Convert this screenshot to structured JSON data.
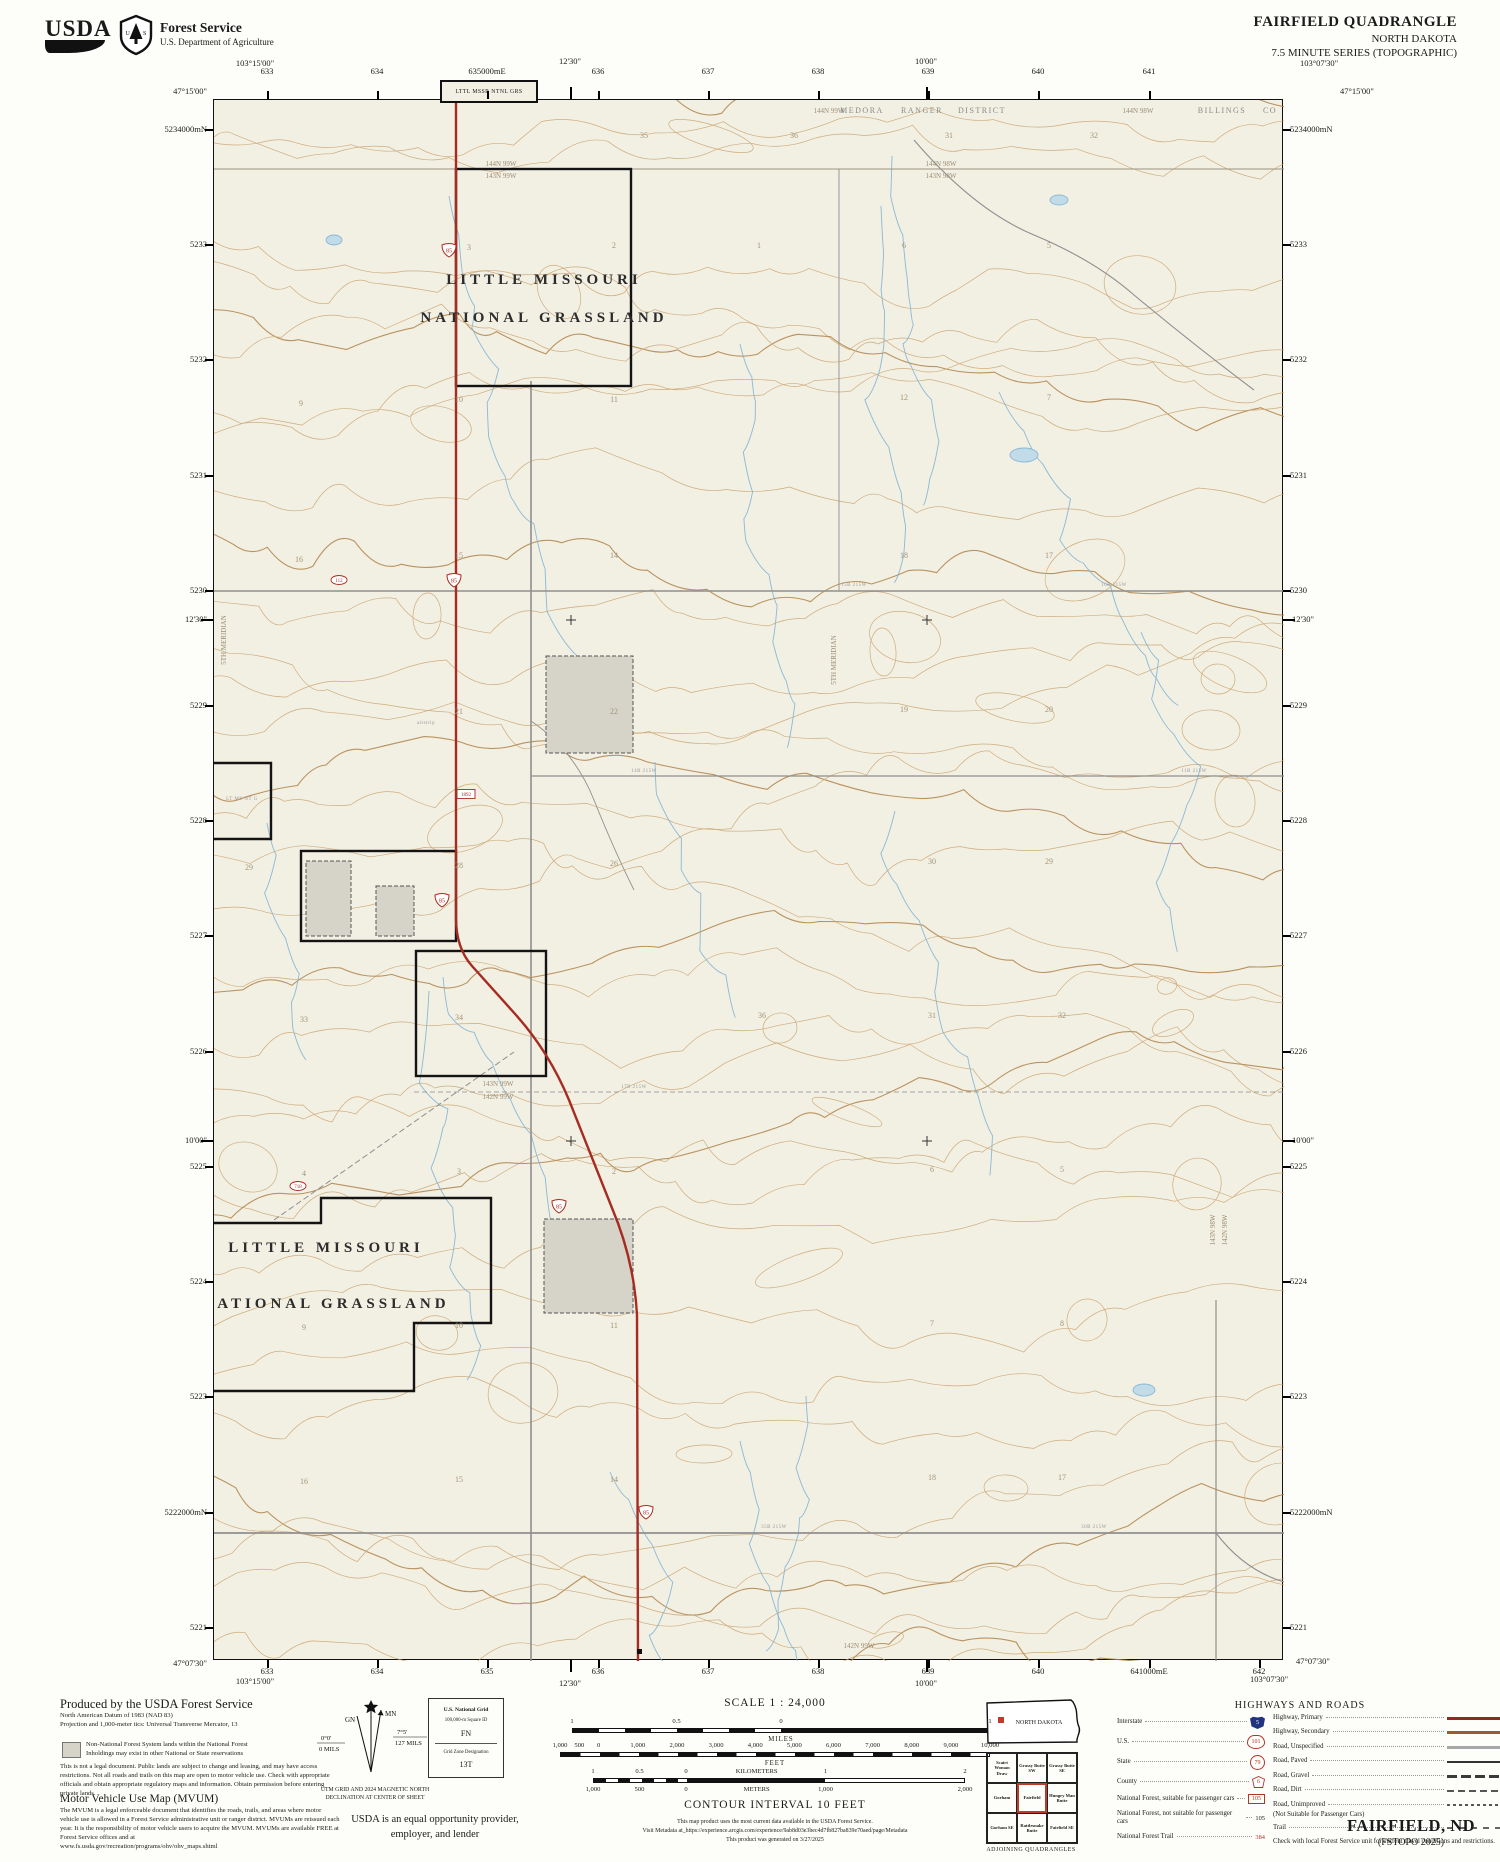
{
  "header": {
    "usda_wordmark": "USDA",
    "agency": "Forest Service",
    "dept": "U.S. Department of Agriculture",
    "quad_title": "FAIRFIELD QUADRANGLE",
    "state_title": "NORTH DAKOTA",
    "series": "7.5 MINUTE SERIES (TOPOGRAPHIC)"
  },
  "collar": {
    "tl_lon": "103°15'00\"",
    "tl_lat": "47°15'00\"",
    "tr_lon": "103°07'30\"",
    "tr_lat": "47°15'00\"",
    "bl_lat": "47°07'30\"",
    "bl_lon": "103°15'00\"",
    "br_lat": "47°07'30\"",
    "br_lon": "103°07'30\"",
    "top_minutes": [
      {
        "t": "12'30\"",
        "x": 570
      },
      {
        "t": "10'00\"",
        "x": 926
      }
    ],
    "bottom_minutes": [
      {
        "t": "12'30\"",
        "x": 570
      },
      {
        "t": "10'00\"",
        "x": 926
      }
    ],
    "side_minutes": [
      {
        "t": "12'30\"",
        "y": 619
      },
      {
        "t": "10'00\"",
        "y": 1140
      }
    ],
    "top_eastings": [
      {
        "t": "633",
        "x": 267
      },
      {
        "t": "634",
        "x": 377
      },
      {
        "t": "635000mE",
        "x": 487
      },
      {
        "t": "636",
        "x": 598
      },
      {
        "t": "637",
        "x": 708
      },
      {
        "t": "638",
        "x": 818
      },
      {
        "t": "639",
        "x": 928
      },
      {
        "t": "640",
        "x": 1038
      },
      {
        "t": "641",
        "x": 1149
      }
    ],
    "bottom_eastings": [
      {
        "t": "633",
        "x": 267
      },
      {
        "t": "634",
        "x": 377
      },
      {
        "t": "635",
        "x": 487
      },
      {
        "t": "636",
        "x": 598
      },
      {
        "t": "637",
        "x": 708
      },
      {
        "t": "638",
        "x": 818
      },
      {
        "t": "639",
        "x": 928
      },
      {
        "t": "640",
        "x": 1038
      },
      {
        "t": "641000mE",
        "x": 1149
      },
      {
        "t": "642",
        "x": 1259
      }
    ],
    "northings": [
      {
        "t": "5234000mN",
        "y": 129
      },
      {
        "t": "5233",
        "y": 244
      },
      {
        "t": "5232",
        "y": 359
      },
      {
        "t": "5231",
        "y": 475
      },
      {
        "t": "5230",
        "y": 590
      },
      {
        "t": "5229",
        "y": 705
      },
      {
        "t": "5228",
        "y": 820
      },
      {
        "t": "5227",
        "y": 935
      },
      {
        "t": "5226",
        "y": 1051
      },
      {
        "t": "5225",
        "y": 1166
      },
      {
        "t": "5224",
        "y": 1281
      },
      {
        "t": "5223",
        "y": 1396
      },
      {
        "t": "5222000mN",
        "y": 1512
      },
      {
        "t": "5221",
        "y": 1627
      }
    ]
  },
  "map": {
    "corner_box_label": "LTTL MSSR NTNL GRS",
    "labels": [
      {
        "t": "LITTLE MISSOURI",
        "x": 330,
        "y": 184,
        "c": "lmng"
      },
      {
        "t": "NATIONAL GRASSLAND",
        "x": 330,
        "y": 222,
        "c": "lmng"
      },
      {
        "t": "LITTLE MISSOURI",
        "x": 112,
        "y": 1152,
        "c": "lmng"
      },
      {
        "t": "NATIONAL GRASSLAND",
        "x": 112,
        "y": 1208,
        "c": "lmng"
      },
      {
        "t": "MEDORA",
        "x": 648,
        "y": 13,
        "c": "district"
      },
      {
        "t": "RANGER",
        "x": 708,
        "y": 13,
        "c": "district"
      },
      {
        "t": "DISTRICT",
        "x": 768,
        "y": 13,
        "c": "district"
      },
      {
        "t": "144N 99W",
        "x": 615,
        "y": 13,
        "c": "twp"
      },
      {
        "t": "144N 98W",
        "x": 924,
        "y": 13,
        "c": "twp"
      },
      {
        "t": "BILLINGS",
        "x": 1008,
        "y": 13,
        "c": "district"
      },
      {
        "t": "CO",
        "x": 1056,
        "y": 13,
        "c": "district"
      },
      {
        "t": "144N 99W",
        "x": 287,
        "y": 66,
        "c": "twp"
      },
      {
        "t": "143N 99W",
        "x": 287,
        "y": 78,
        "c": "twp"
      },
      {
        "t": "144N 98W",
        "x": 727,
        "y": 66,
        "c": "twp"
      },
      {
        "t": "143N 98W",
        "x": 727,
        "y": 78,
        "c": "twp"
      },
      {
        "t": "143N 99W",
        "x": 284,
        "y": 986,
        "c": "twp"
      },
      {
        "t": "142N 99W",
        "x": 284,
        "y": 999,
        "c": "twp"
      },
      {
        "t": "142N 99W",
        "x": 645,
        "y": 1548,
        "c": "twp"
      },
      {
        "t": "143N 98W",
        "x": 1001,
        "y": 1130,
        "c": "twp",
        "r": -90
      },
      {
        "t": "142N 98W",
        "x": 1013,
        "y": 1130,
        "c": "twp",
        "r": -90
      },
      {
        "t": "5TH MERIDIAN",
        "x": 622,
        "y": 560,
        "c": "twp",
        "r": -90
      },
      {
        "t": "5TH MERIDIAN",
        "x": 12,
        "y": 540,
        "c": "twp",
        "r": -90
      },
      {
        "t": "LT MS NT G",
        "x": 28,
        "y": 700,
        "c": "tinylab"
      },
      {
        "t": "airstrip",
        "x": 212,
        "y": 624,
        "c": "tinylab"
      }
    ],
    "road_names": [
      {
        "t": "14B 215W",
        "x": 430,
        "y": 672
      },
      {
        "t": "15B 215W",
        "x": 640,
        "y": 486
      },
      {
        "t": "16B 215W",
        "x": 900,
        "y": 486
      },
      {
        "t": "17B 215W",
        "x": 420,
        "y": 988
      },
      {
        "t": "35B 215W",
        "x": 560,
        "y": 1428
      },
      {
        "t": "30B 215W",
        "x": 880,
        "y": 1428
      },
      {
        "t": "11B 215W",
        "x": 980,
        "y": 672
      }
    ],
    "sections": [
      {
        "t": "35",
        "x": 430,
        "y": 38
      },
      {
        "t": "36",
        "x": 580,
        "y": 38
      },
      {
        "t": "31",
        "x": 735,
        "y": 38
      },
      {
        "t": "32",
        "x": 880,
        "y": 38
      },
      {
        "t": "3",
        "x": 255,
        "y": 150
      },
      {
        "t": "2",
        "x": 400,
        "y": 148
      },
      {
        "t": "1",
        "x": 545,
        "y": 148
      },
      {
        "t": "6",
        "x": 690,
        "y": 148
      },
      {
        "t": "5",
        "x": 835,
        "y": 148
      },
      {
        "t": "9",
        "x": 87,
        "y": 306
      },
      {
        "t": "10",
        "x": 245,
        "y": 302
      },
      {
        "t": "11",
        "x": 400,
        "y": 302
      },
      {
        "t": "12",
        "x": 690,
        "y": 300
      },
      {
        "t": "7",
        "x": 835,
        "y": 300
      },
      {
        "t": "16",
        "x": 85,
        "y": 462
      },
      {
        "t": "15",
        "x": 245,
        "y": 458
      },
      {
        "t": "14",
        "x": 400,
        "y": 458
      },
      {
        "t": "18",
        "x": 690,
        "y": 458
      },
      {
        "t": "17",
        "x": 835,
        "y": 458
      },
      {
        "t": "21",
        "x": 245,
        "y": 614
      },
      {
        "t": "22",
        "x": 400,
        "y": 614
      },
      {
        "t": "19",
        "x": 690,
        "y": 612
      },
      {
        "t": "20",
        "x": 835,
        "y": 612
      },
      {
        "t": "29",
        "x": 35,
        "y": 770
      },
      {
        "t": "28",
        "x": 245,
        "y": 768
      },
      {
        "t": "26",
        "x": 400,
        "y": 766
      },
      {
        "t": "30",
        "x": 718,
        "y": 764
      },
      {
        "t": "29",
        "x": 835,
        "y": 764
      },
      {
        "t": "33",
        "x": 90,
        "y": 922
      },
      {
        "t": "34",
        "x": 245,
        "y": 920
      },
      {
        "t": "36",
        "x": 548,
        "y": 918
      },
      {
        "t": "31",
        "x": 718,
        "y": 918
      },
      {
        "t": "32",
        "x": 848,
        "y": 918
      },
      {
        "t": "4",
        "x": 90,
        "y": 1076
      },
      {
        "t": "3",
        "x": 245,
        "y": 1074
      },
      {
        "t": "2",
        "x": 400,
        "y": 1074
      },
      {
        "t": "6",
        "x": 718,
        "y": 1072
      },
      {
        "t": "5",
        "x": 848,
        "y": 1072
      },
      {
        "t": "9",
        "x": 90,
        "y": 1230
      },
      {
        "t": "10",
        "x": 245,
        "y": 1228
      },
      {
        "t": "11",
        "x": 400,
        "y": 1228
      },
      {
        "t": "7",
        "x": 718,
        "y": 1226
      },
      {
        "t": "8",
        "x": 848,
        "y": 1226
      },
      {
        "t": "16",
        "x": 90,
        "y": 1384
      },
      {
        "t": "15",
        "x": 245,
        "y": 1382
      },
      {
        "t": "14",
        "x": 400,
        "y": 1382
      },
      {
        "t": "18",
        "x": 718,
        "y": 1380
      },
      {
        "t": "17",
        "x": 848,
        "y": 1380
      }
    ],
    "route_shields": [
      {
        "num": "85",
        "x": 235,
        "y": 150
      },
      {
        "num": "85",
        "x": 240,
        "y": 480
      },
      {
        "num": "85",
        "x": 228,
        "y": 800
      },
      {
        "num": "85",
        "x": 345,
        "y": 1106
      },
      {
        "num": "85",
        "x": 432,
        "y": 1412
      }
    ],
    "road_badges": [
      {
        "t": "1892",
        "x": 252,
        "y": 694,
        "shape": "rect"
      },
      {
        "t": "112",
        "x": 125,
        "y": 480,
        "shape": "oval"
      },
      {
        "t": "718",
        "x": 84,
        "y": 1086,
        "shape": "oval"
      }
    ]
  },
  "footer": {
    "produced": [
      "Produced by the USDA Forest Service",
      "North American Datum of 1983 (NAD 83)",
      "Projection and 1,000-meter tics: Universal Transverse Mercator, 13"
    ],
    "nonnf": [
      "Non-National Forest System lands within the National Forest",
      "Inholdings may exist in other National or State reservations"
    ],
    "legal": "This is not a legal document. Public lands are subject to change and leasing, and may have access restrictions. Not all roads and trails on this map are open to motor vehicle use. Check with appropriate officials and obtain appropriate regulatory maps and information. Obtain permission before entering private lands.",
    "mvum_title": "Motor Vehicle Use Map (MVUM)",
    "mvum_body": "The MVUM is a legal enforceable document that identifies the roads, trails, and areas where motor vehicle use is allowed in a Forest Service administrative unit or ranger district. MVUMs are reissued each year. It is the responsibility of motor vehicle users to acquire the MVUM. MVUMs are available FREE at Forest Service offices and at",
    "mvum_url": "www.fs.usda.gov/recreation/programs/ohv/ohv_maps.shtml",
    "declination": {
      "mn": "MN",
      "gn": "GN",
      "left_deg": "0°0'",
      "left_mils": "0 MILS",
      "right_deg": "7°5'",
      "right_mils": "127 MILS",
      "caption": [
        "UTM GRID AND 2024 MAGNETIC NORTH",
        "DECLINATION AT CENTER OF SHEET"
      ]
    },
    "usng": {
      "title": "U.S. National Grid",
      "square_id_label": "100,000-m Square ID",
      "square_id": "FN",
      "zone_label": "Grid Zone Designation",
      "zone": "13T"
    },
    "eo": [
      "USDA is an equal opportunity provider,",
      "employer, and lender"
    ],
    "scale_title": "SCALE 1 : 24,000",
    "bars": {
      "miles": {
        "caption": "MILES",
        "labels": [
          {
            "t": "1",
            "f": 0
          },
          {
            "t": "0.5",
            "f": 0.25
          },
          {
            "t": "0",
            "f": 0.5
          },
          {
            "t": "1",
            "f": 1
          }
        ]
      },
      "feet": {
        "caption": "FEET",
        "labels": [
          {
            "t": "1,000",
            "f": 0
          },
          {
            "t": "500",
            "f": 0.045
          },
          {
            "t": "0",
            "f": 0.09
          },
          {
            "t": "1,000",
            "f": 0.181
          },
          {
            "t": "2,000",
            "f": 0.272
          },
          {
            "t": "3,000",
            "f": 0.363
          },
          {
            "t": "4,000",
            "f": 0.454
          },
          {
            "t": "5,000",
            "f": 0.545
          },
          {
            "t": "6,000",
            "f": 0.636
          },
          {
            "t": "7,000",
            "f": 0.727
          },
          {
            "t": "8,000",
            "f": 0.818
          },
          {
            "t": "9,000",
            "f": 0.909
          },
          {
            "t": "10,000",
            "f": 1
          }
        ]
      },
      "km_top": {
        "labels": [
          {
            "t": "1",
            "f": 0
          },
          {
            "t": "0.5",
            "f": 0.125
          },
          {
            "t": "0",
            "f": 0.25
          },
          {
            "t": "KILOMETERS",
            "f": 0.44
          },
          {
            "t": "1",
            "f": 0.625
          },
          {
            "t": "2",
            "f": 1
          }
        ]
      },
      "km_bottom": {
        "labels": [
          {
            "t": "1,000",
            "f": 0
          },
          {
            "t": "500",
            "f": 0.125
          },
          {
            "t": "0",
            "f": 0.25
          },
          {
            "t": "METERS",
            "f": 0.44
          },
          {
            "t": "1,000",
            "f": 0.625
          },
          {
            "t": "2,000",
            "f": 1
          }
        ]
      }
    },
    "contour_note": "CONTOUR INTERVAL 10 FEET",
    "meta": [
      "This map product uses the most current data available in the USDA Forest Service.",
      "Visit Metadata at_https://experience.arcgis.com/experience/9ab8d03e3bec4d7fb827ba839e70aed/page/Metadata",
      "This product was generated on 3/27/2025"
    ],
    "inset_state": "NORTH DAKOTA",
    "adjoining": {
      "cells": [
        "Scairt Woman Draw",
        "Grassy Butte SW",
        "Grassy Butte SE",
        "Gorham",
        "Fairfield",
        "Hungry Man Butte",
        "Gorham SE",
        "Rattlesnake Butte",
        "Fairfield SE"
      ],
      "caption": "ADJOINING QUADRANGLES"
    },
    "legend": {
      "title": "HIGHWAYS AND ROADS",
      "shields": [
        {
          "label": "Interstate",
          "type": "interstate",
          "num": "5"
        },
        {
          "label": "U.S.",
          "type": "us",
          "num": "101"
        },
        {
          "label": "State",
          "type": "state",
          "num": "79"
        },
        {
          "label": "County",
          "type": "county",
          "num": "6"
        },
        {
          "label": "National Forest, suitable for passenger cars",
          "type": "nf-box",
          "num": "105"
        },
        {
          "label": "National Forest, not suitable for passenger cars",
          "type": "nf-plain",
          "num": "105"
        },
        {
          "label": "National Forest Trail",
          "type": "nf-trail",
          "num": "384"
        }
      ],
      "roads": [
        {
          "label": "Highway, Primary",
          "style": "hwy-primary"
        },
        {
          "label": "Highway, Secondary",
          "style": "hwy-secondary"
        },
        {
          "label": "Road, Unspecified",
          "style": "road-unspec"
        },
        {
          "label": "Road, Paved",
          "style": "road-paved"
        },
        {
          "label": "Road, Gravel",
          "style": "road-gravel"
        },
        {
          "label": "Road, Dirt",
          "style": "road-dirt"
        },
        {
          "label": "Road, Unimproved",
          "style": "road-unimproved",
          "note": "(Not Suitable for Passenger Cars)"
        },
        {
          "label": "Trail",
          "style": "trail"
        }
      ],
      "note": "Check with local Forest Service unit for current travel conditions and restrictions."
    },
    "doc_title": "FAIRFIELD, ND",
    "doc_sub": "(FSTOPO 2025)"
  }
}
